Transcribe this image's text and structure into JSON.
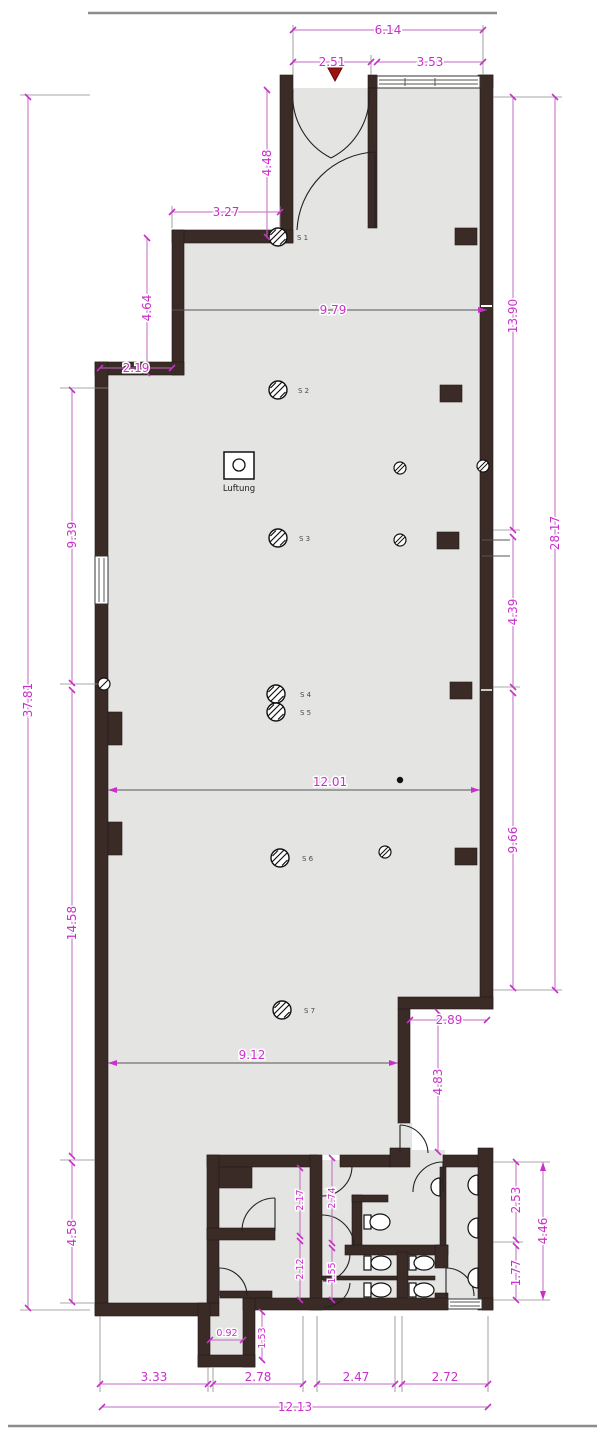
{
  "drawing": {
    "type": "architectural-floor-plan",
    "colors": {
      "wall": "#3a2b27",
      "floor": "#e4e4e2",
      "dimension_text": "#cb2fcb",
      "dimension_line": "#c06ac0",
      "background": "#ffffff",
      "entrance_marker": "#a01010"
    },
    "dims": {
      "top_total": "6.14",
      "top_left": "2.51",
      "top_right": "3.53",
      "entry_height": "4.48",
      "entry_width": "3.27",
      "step_height": "4.64",
      "step_width": "2.19",
      "hall_width_top": "9.79",
      "right_upper": "13.90",
      "right_total": "28.17",
      "right_mid": "4.39",
      "right_lower": "9.66",
      "left_total": "37.81",
      "left_upper": "9.39",
      "left_lower": "14.58",
      "left_bottom": "4.58",
      "hall_mid": "12.01",
      "hall_lower": "9.12",
      "notch_width": "2.89",
      "notch_height": "4.83",
      "wc_room_upper": "2.17",
      "wc_mid_upper": "2.74",
      "wc_room_lower": "2.12",
      "wc_mid_lower": "1.55",
      "bump_width": "0.92",
      "bump_height": "1.53",
      "br_upper": "2.53",
      "br_lower": "1.77",
      "br_total": "4.46",
      "bottom_1": "3.33",
      "bottom_2": "2.78",
      "bottom_3": "2.47",
      "bottom_4": "2.72",
      "bottom_total": "12.13"
    },
    "labels": {
      "s1": "S 1",
      "s2": "S 2",
      "s3": "S 3",
      "s4": "S 4",
      "s5": "S 5",
      "s6": "S 6",
      "s7": "S 7",
      "ventilation": "Luftung"
    }
  }
}
